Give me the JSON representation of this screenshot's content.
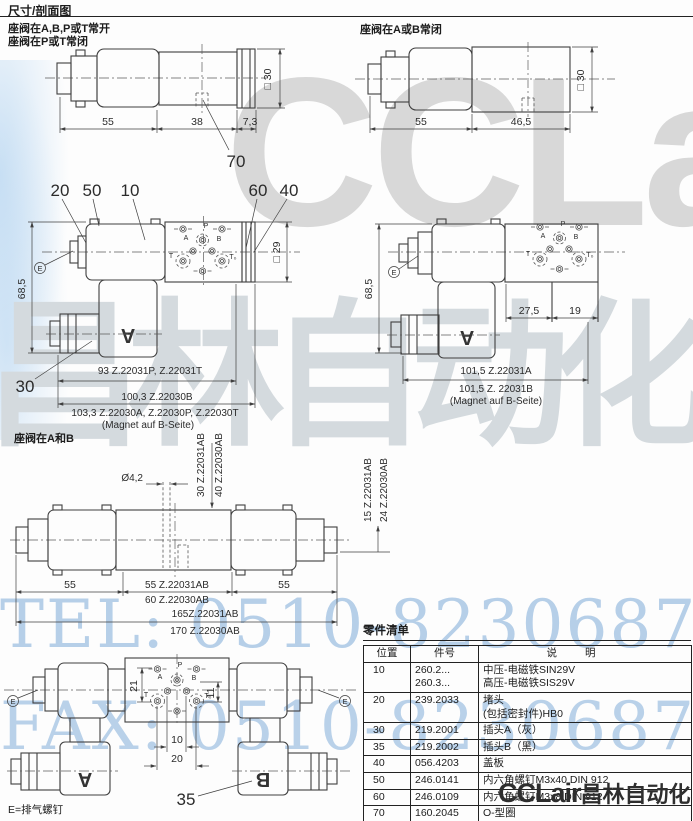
{
  "header": {
    "title": "尺寸/剖面图"
  },
  "captions": {
    "top_left_1": "座阀在A,B,P或T常开",
    "top_left_2": "座阀在P或T常闭",
    "top_right": "座阀在A或B常闭",
    "mid": "座阀在A和B",
    "vent_note": "E=排气螺钉"
  },
  "d1": {
    "w1": "55",
    "w2": "38",
    "w3": "7,3",
    "sq": "□ 30",
    "c70": "70"
  },
  "d2": {
    "w1": "55",
    "w2": "46,5",
    "sq": "□ 30"
  },
  "d3": {
    "c20": "20",
    "c50": "50",
    "c10": "10",
    "c60": "60",
    "c40": "40",
    "c30": "30",
    "e": "E",
    "h": "68,5",
    "sq": "□ 29",
    "coil": "A",
    "p": "P",
    "a": "A",
    "b": "B",
    "t": "T",
    "t0": "T₀",
    "len1": "93  Z.22031P, Z.22031T",
    "len2": "100,3  Z.22030B",
    "len3": "103,3  Z.22030A, Z.22030P, Z.22030T",
    "note": "(Magnet auf B-Seite)"
  },
  "d4": {
    "e": "E",
    "h": "68,5",
    "w1": "27,5",
    "w2": "19",
    "coil": "A",
    "p": "P",
    "a": "A",
    "b": "B",
    "t": "T",
    "t0": "T₀",
    "len1": "101,5  Z.22031A",
    "len2": "101,5  Z. 22031B",
    "note": "(Magnet auf B-Seite)"
  },
  "d5": {
    "dia": "Ø4,2",
    "vl1": "30  Z.22031AB",
    "vl2": "40  Z.22030AB",
    "vr1": "15  Z.22031AB",
    "vr2": "24  Z.22030AB",
    "w1": "55",
    "w2": "55  Z.22031AB",
    "w3": "60  Z.22030AB",
    "w4": "55",
    "t1": "165Z.22031AB",
    "t2": "170 Z.22030AB"
  },
  "d6": {
    "e1": "E",
    "e2": "E",
    "coil_a": "A",
    "coil_b": "B",
    "c35": "35",
    "d21": "21",
    "d11": "11",
    "d10": "10",
    "d20": "20",
    "p": "P",
    "a": "A",
    "b": "B",
    "t": "T",
    "t0": "T₀"
  },
  "parts_list": {
    "title": "零件清单",
    "columns": [
      "位置",
      "件号",
      "说明"
    ],
    "rows": [
      {
        "pos": "10",
        "part1": "260.2...",
        "part2": "260.3...",
        "desc1": "中压-电磁铁SIN29V",
        "desc2": "高压-电磁铁SIS29V"
      },
      {
        "pos": "20",
        "part1": "239.2033",
        "desc1": "堵头",
        "desc2": "(包括密封件)HB0"
      },
      {
        "pos": "30",
        "part1": "219.2001",
        "desc1": "插头A（灰）"
      },
      {
        "pos": "35",
        "part1": "219.2002",
        "desc1": "插头B（黑）"
      },
      {
        "pos": "40",
        "part1": "056.4203",
        "desc1": "盖板"
      },
      {
        "pos": "50",
        "part1": "246.0141",
        "desc1": "内六角螺钉M3x40 DIN 912"
      },
      {
        "pos": "60",
        "part1": "246.0109",
        "desc1": "内六角螺钉M3x8 DIN 912"
      },
      {
        "pos": "70",
        "part1": "160.2045",
        "desc1": "O-型圈"
      }
    ]
  },
  "watermarks": {
    "brand": "CCLair",
    "brand_cn": "昌林自动化",
    "tel": "TEL: 0510-82306871",
    "fax": "FAX: 0510-82306872",
    "colors": {
      "gray": "#d8d8d8",
      "blue": "#b6cfe8"
    }
  },
  "logo": {
    "latin": "CCLair",
    "cjk": "昌林自动化"
  }
}
